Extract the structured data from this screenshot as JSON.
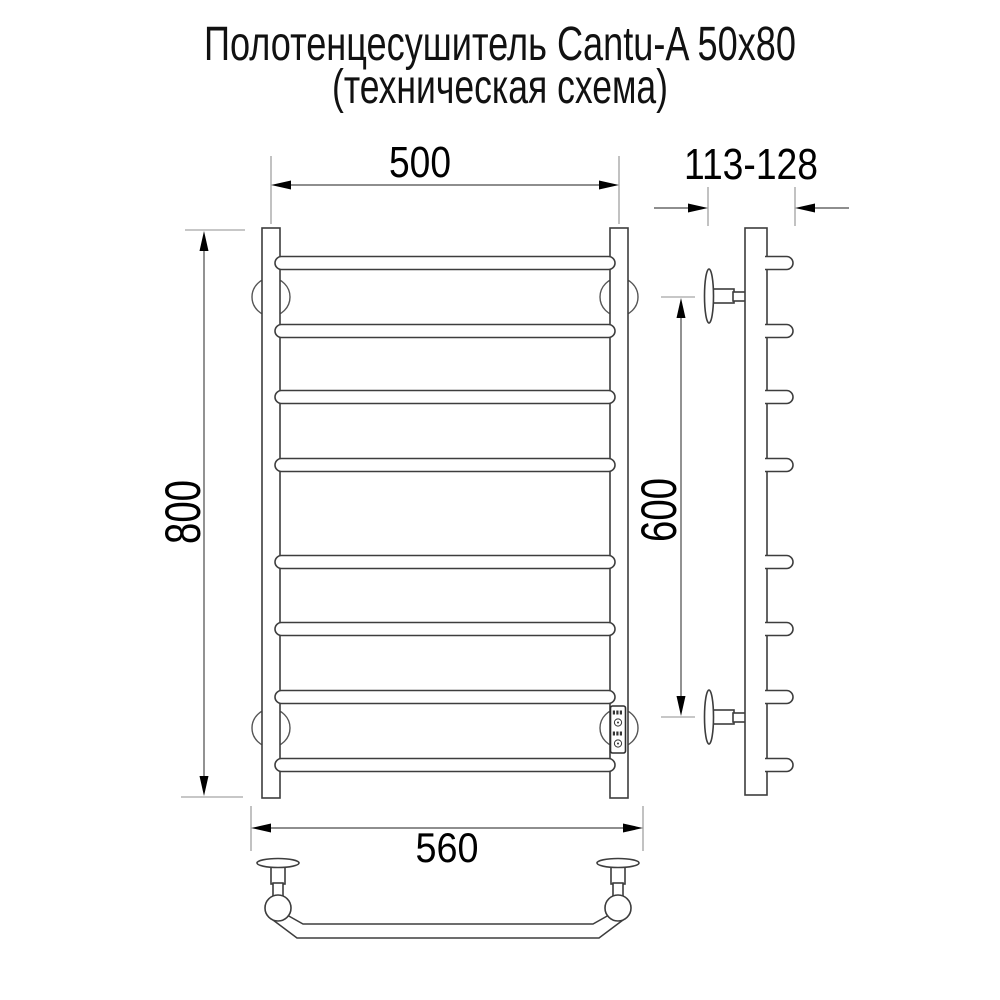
{
  "title": {
    "line1": "Полотенцесушитель Cantu-A 50x80",
    "line2": "(техническая схема)"
  },
  "dimensions": {
    "overall_width": "500",
    "depth_range": "113-128",
    "overall_height": "800",
    "mount_spacing": "600",
    "bottom_width": "560"
  },
  "colors": {
    "background": "#ffffff",
    "outline": "#3d3d3d",
    "dimension_line": "#4a4a4a",
    "extension_line": "#8f8f8f",
    "text": "#000000"
  },
  "structure": {
    "rung_count": 8,
    "views": [
      "front",
      "side",
      "top"
    ]
  }
}
